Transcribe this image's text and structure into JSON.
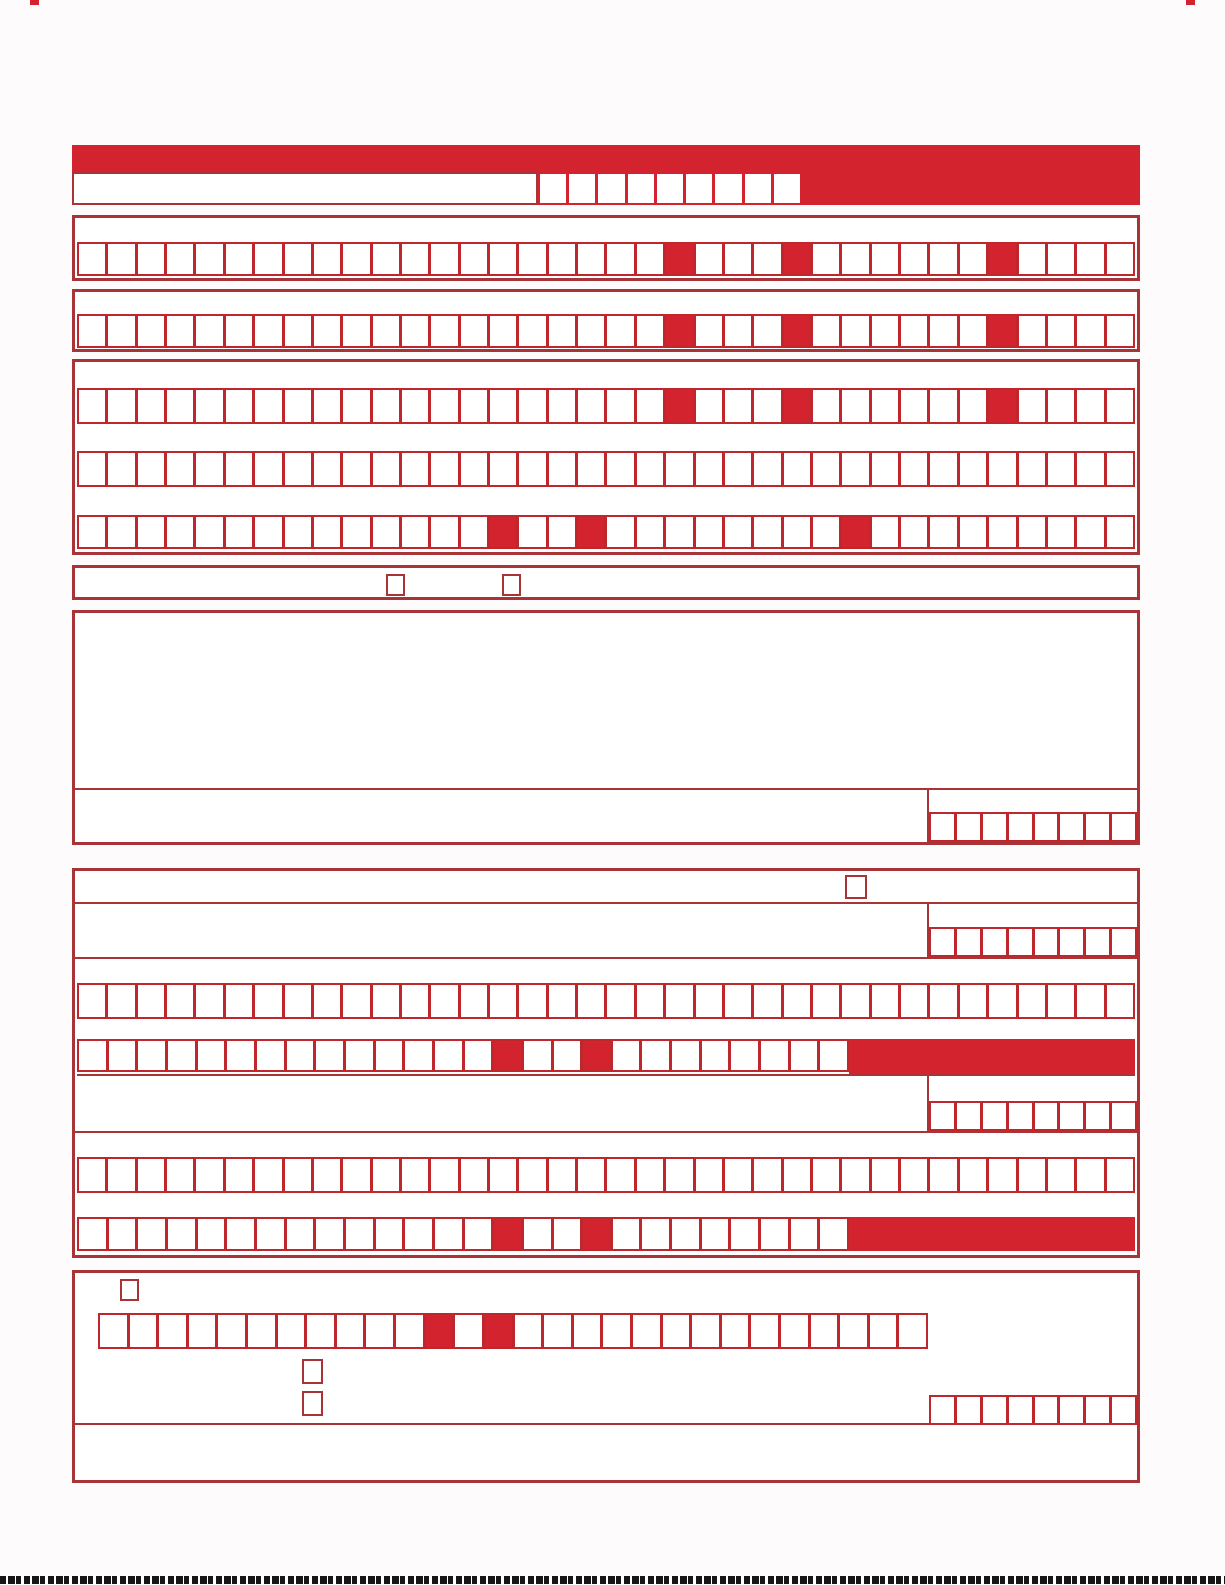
{
  "meta": {
    "description": "Blank red machine-readable form template with empty character comb fields, separator cells, checkboxes, free-text areas and date boxes. No printed text visible."
  },
  "colors": {
    "fill_red": "#d2232e",
    "border_red": "#a83438",
    "cell_border_red": "#c0272d",
    "page_bg": "#fdfbfb",
    "barcode": "#161616"
  },
  "header": {
    "reference_cells": {
      "cells": 9,
      "filled": []
    }
  },
  "comb_rows": {
    "section2": {
      "cells": 36,
      "filled": [
        20,
        24,
        31
      ]
    },
    "section3": {
      "cells": 36,
      "filled": [
        20,
        24,
        31
      ]
    },
    "section4_row1": {
      "cells": 36,
      "filled": [
        20,
        24,
        31
      ]
    },
    "section4_row2": {
      "cells": 36,
      "filled": []
    },
    "section4_row3": {
      "cells": 36,
      "filled": [
        14,
        17,
        26
      ]
    },
    "section7_row1": {
      "cells": 36,
      "filled": []
    },
    "section7_row2": {
      "cells": 26,
      "filled": [
        14,
        17
      ]
    },
    "section7_row3": {
      "cells": 36,
      "filled": []
    },
    "section7_row4": {
      "cells": 26,
      "filled": [
        14,
        17
      ]
    },
    "section8_row": {
      "cells": 28,
      "filled": [
        11,
        13
      ]
    }
  },
  "date_groups": {
    "d1": {
      "cells": 8,
      "filled": []
    },
    "d2": {
      "cells": 8,
      "filled": []
    },
    "d3": {
      "cells": 8,
      "filled": []
    },
    "d4": {
      "cells": 8,
      "filled": []
    }
  },
  "checkbox_count": 6
}
